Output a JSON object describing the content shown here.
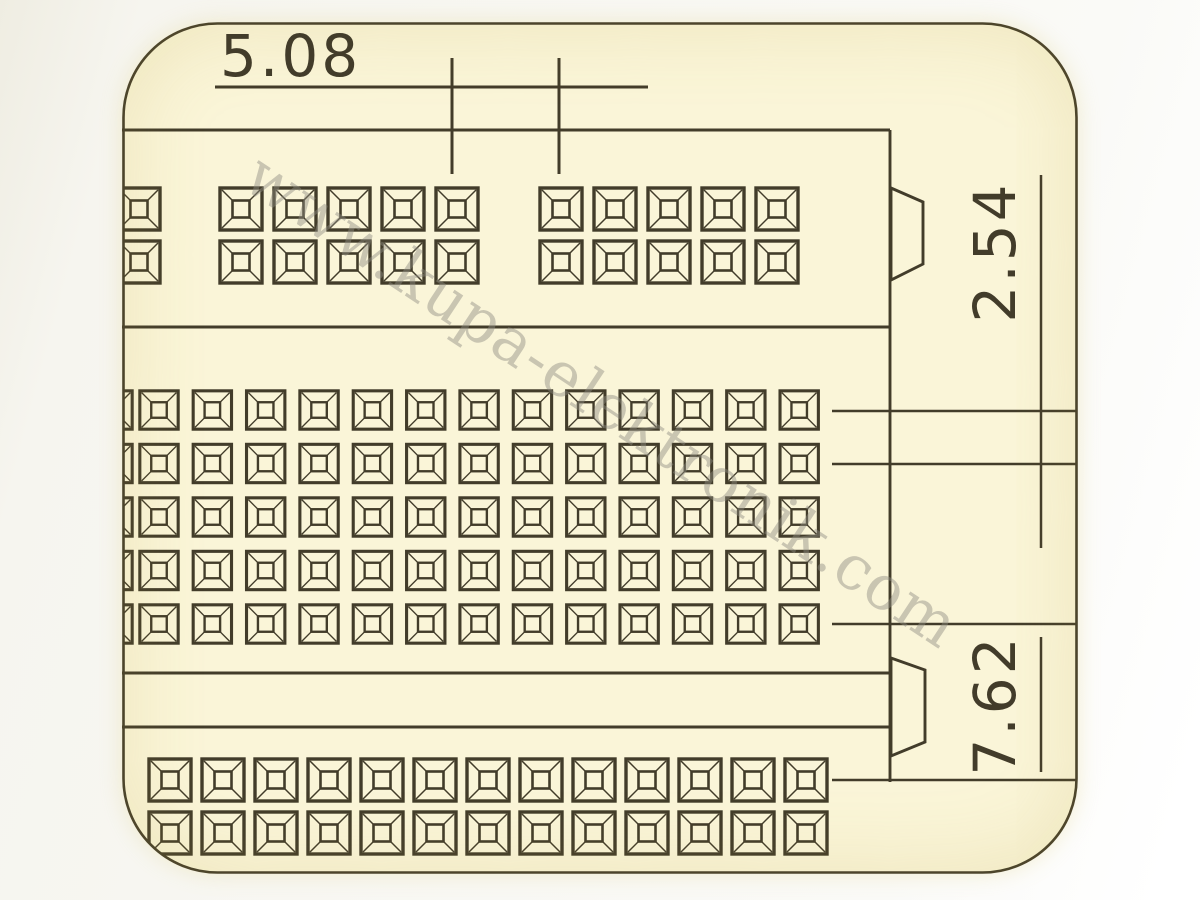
{
  "dimensions": {
    "top_pitch": "5.08",
    "right_pitch": "2.54",
    "right_section_gap": "7.62"
  },
  "watermark": {
    "text": "www.kupa-elektronik.com"
  },
  "colors": {
    "ink": "#423c2a",
    "paper": "#faf5d8",
    "watermark": "#8f8c82"
  },
  "drawing": {
    "units": "mm",
    "pad_grids": [
      {
        "name": "top-row-left-clipped-pads",
        "x": 116,
        "y": 186,
        "cols": 1,
        "rows": 2,
        "pitch_x": 54,
        "pitch_y": 53,
        "pad_size": 46
      },
      {
        "name": "top-row-group-1",
        "x": 218,
        "y": 186,
        "cols": 5,
        "rows": 2,
        "pitch_x": 54,
        "pitch_y": 53,
        "pad_size": 46
      },
      {
        "name": "top-row-group-2",
        "x": 538,
        "y": 186,
        "cols": 5,
        "rows": 2,
        "pitch_x": 54,
        "pitch_y": 53,
        "pad_size": 46
      },
      {
        "name": "middle-grid-left-clipped-pads",
        "x": 92,
        "y": 389,
        "cols": 1,
        "rows": 5,
        "pitch_x": 53.35,
        "pitch_y": 53.5,
        "pad_size": 42
      },
      {
        "name": "middle-grid",
        "x": 138,
        "y": 389,
        "cols": 13,
        "rows": 5,
        "pitch_x": 53.35,
        "pitch_y": 53.5,
        "pad_size": 42
      },
      {
        "name": "bottom-grid",
        "x": 147,
        "y": 757,
        "cols": 13,
        "rows": 2,
        "pitch_x": 53,
        "pitch_y": 53,
        "pad_size": 46
      }
    ]
  }
}
